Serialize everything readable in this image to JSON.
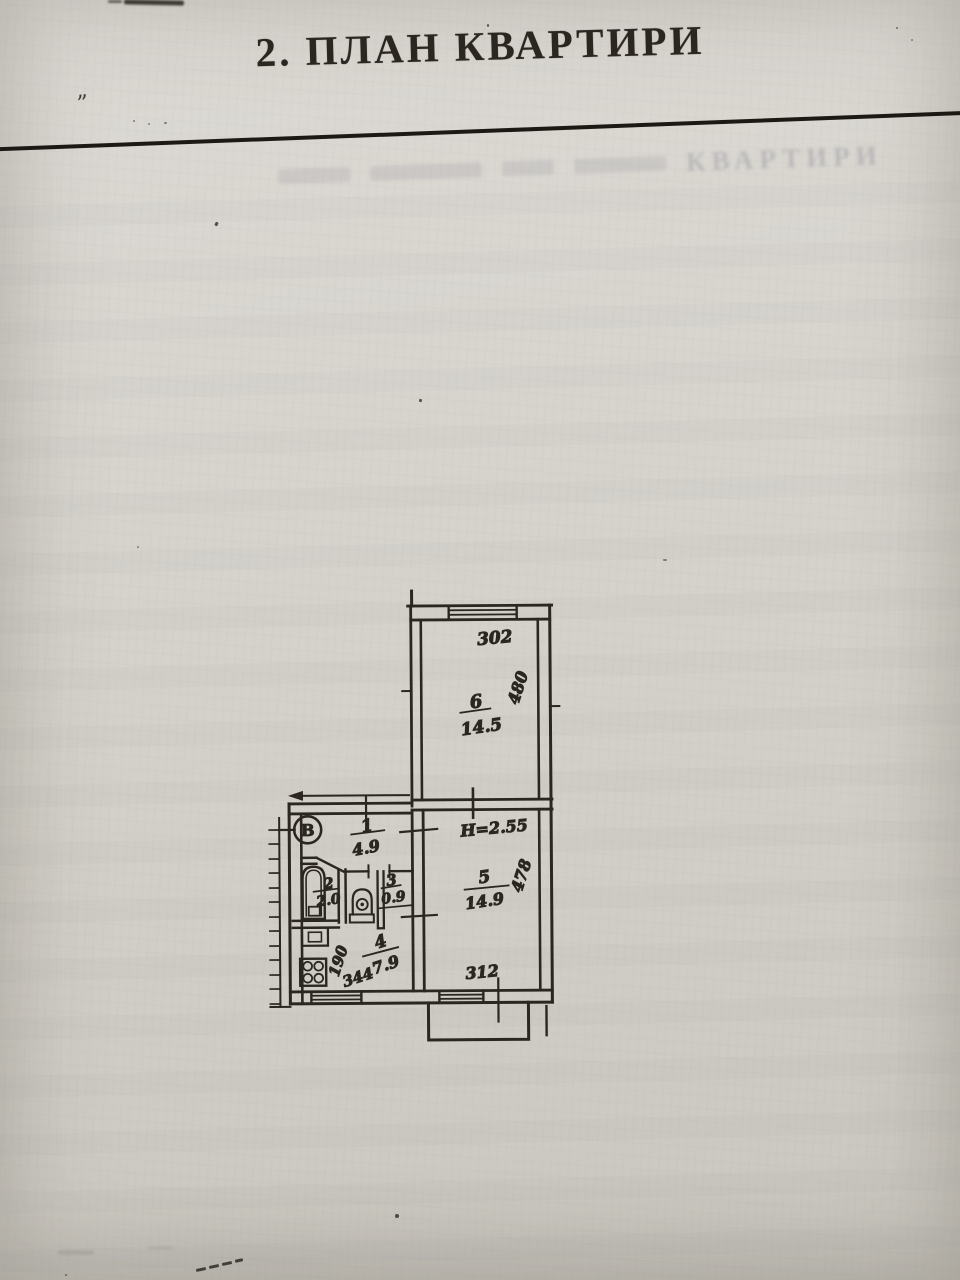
{
  "page": {
    "title": "2. ПЛАН КВАРТИРИ",
    "ghost_word": "КВАРТИРИ"
  },
  "plan": {
    "entry_marker": "В",
    "rooms": {
      "r6": {
        "number": "6",
        "area": "14.5"
      },
      "r5": {
        "number": "5",
        "area": "14.9"
      },
      "r1": {
        "number": "1",
        "area": "4.9"
      },
      "r2": {
        "number": "2",
        "area": "2.0"
      },
      "r3": {
        "number": "3",
        "area": "0.9"
      },
      "r4": {
        "number": "4",
        "area": "7.9"
      }
    },
    "dimensions": {
      "room6_width": "302",
      "room6_depth": "480",
      "room5_depth": "478",
      "room5_width": "312",
      "kitchen_depth": "190",
      "kitchen_width": "344",
      "ceiling_height": "H=2.55"
    }
  },
  "colors": {
    "paper": "#d7d4ce",
    "ink": "#2b2620"
  }
}
